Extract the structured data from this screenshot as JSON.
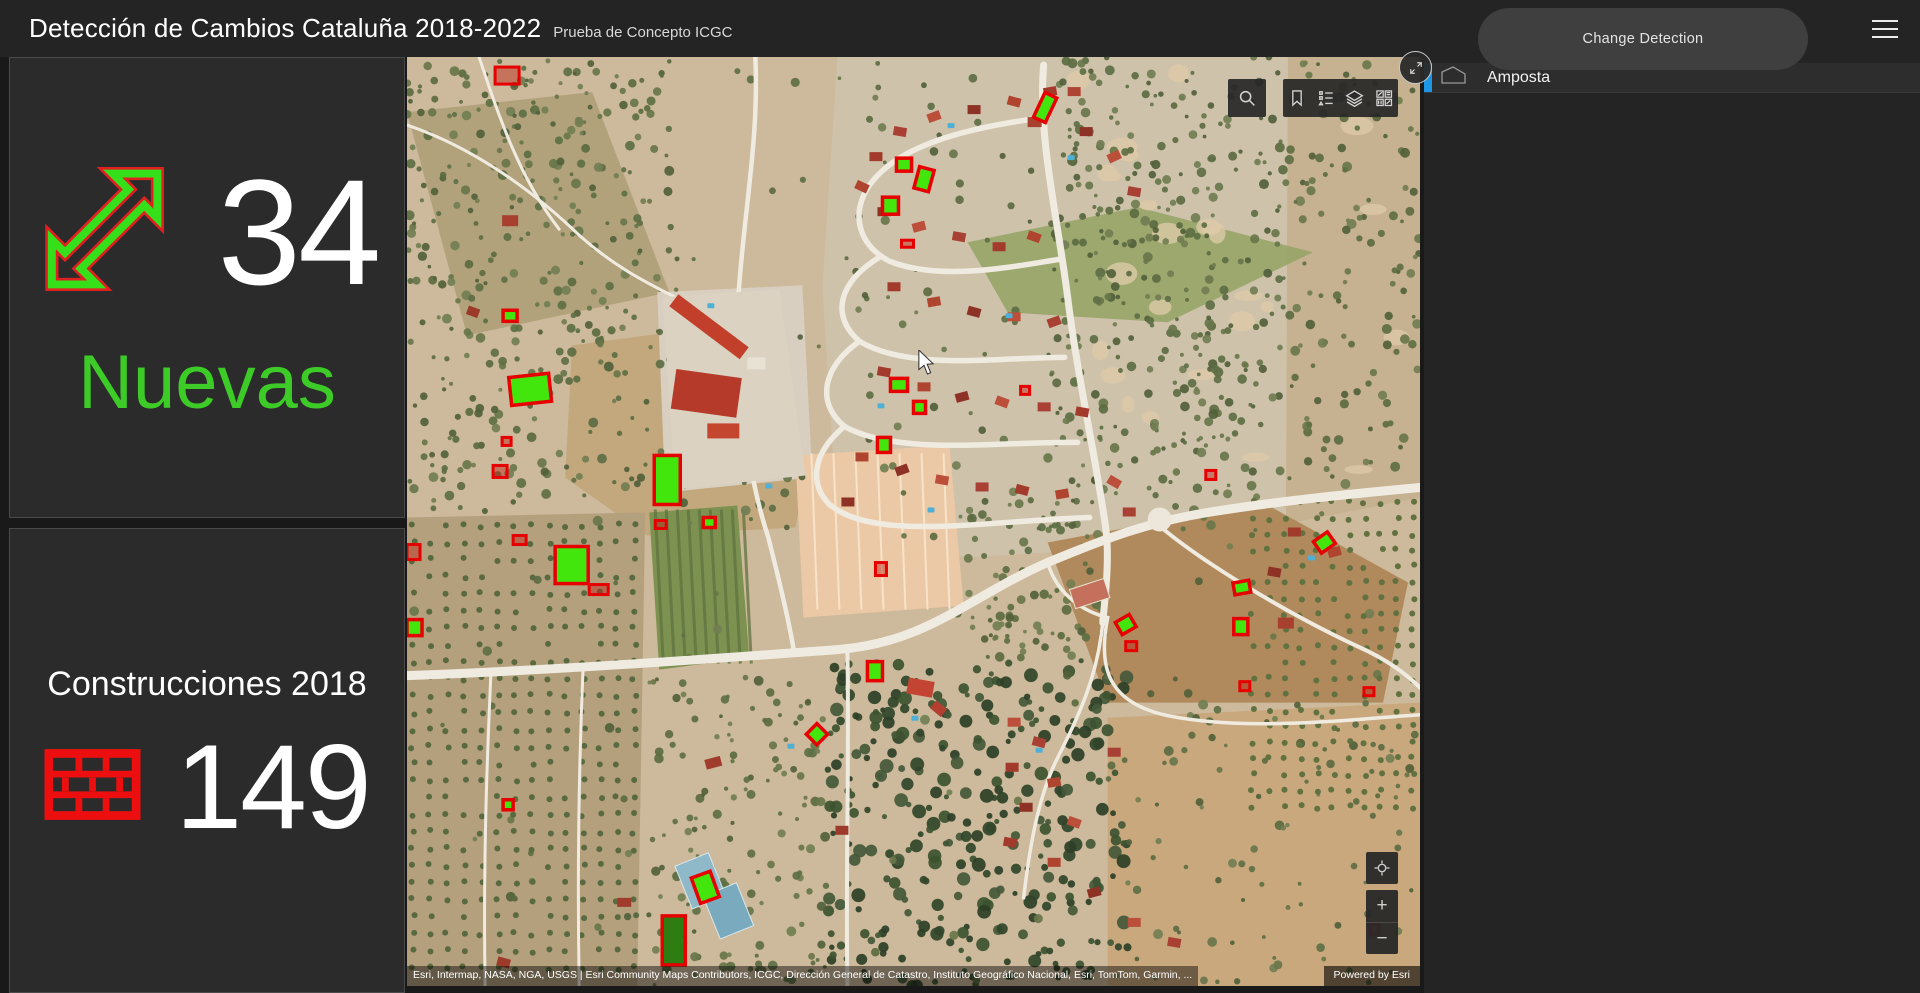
{
  "header": {
    "title": "Detección de Cambios Cataluña 2018-2022",
    "subtitle": "Prueba de Concepto ICGC",
    "change_detection_label": "Change Detection",
    "menu_icon": "hamburger-menu"
  },
  "stats": {
    "nuevas": {
      "value": "34",
      "label": "Nuevas",
      "icon": "arrow-up-right-icon",
      "label_color": "#3DCB27",
      "icon_green": "#35E01A",
      "icon_red": "#E02020"
    },
    "construcciones": {
      "value": "149",
      "label": "Construcciones 2018",
      "icon": "brick-wall-icon",
      "icon_color": "#ED0F0F"
    }
  },
  "map": {
    "toolbar_icons": [
      "search-icon",
      "bookmark-icon",
      "legend-list-icon",
      "layers-icon",
      "basemap-gallery-icon"
    ],
    "corner_button_icon": "expand-icon",
    "controls": {
      "locate_icon": "locate-icon",
      "zoom_in": "+",
      "zoom_out": "−"
    },
    "attribution": "Esri, Intermap, NASA, NGA, USGS | Esri Community Maps Contributors, ICGC, Dirección General de Catastro, Instituto Geográfico Nacional, Esri, TomTom, Garmin, ...",
    "powered_by": "Powered by Esri",
    "marker_colors": {
      "nueva_fill": "#43E60C",
      "nueva_fill_dark": "#2E7D12",
      "stroke": "#E60000",
      "construccion_fill": "rgba(190,30,20,0.45)"
    },
    "markers": [
      {
        "x": 96,
        "y": 253,
        "w": 14,
        "h": 11,
        "r": 0,
        "t": "n"
      },
      {
        "x": 103,
        "y": 318,
        "w": 40,
        "h": 28,
        "r": -6,
        "t": "n"
      },
      {
        "x": 247,
        "y": 398,
        "w": 26,
        "h": 49,
        "r": 0,
        "t": "n"
      },
      {
        "x": 489,
        "y": 101,
        "w": 15,
        "h": 13,
        "r": 0,
        "t": "n"
      },
      {
        "x": 509,
        "y": 111,
        "w": 15,
        "h": 22,
        "r": 15,
        "t": "n"
      },
      {
        "x": 475,
        "y": 140,
        "w": 16,
        "h": 17,
        "r": 0,
        "t": "n"
      },
      {
        "x": 483,
        "y": 321,
        "w": 17,
        "h": 13,
        "r": 0,
        "t": "n"
      },
      {
        "x": 470,
        "y": 380,
        "w": 13,
        "h": 15,
        "r": 0,
        "t": "n"
      },
      {
        "x": 506,
        "y": 344,
        "w": 12,
        "h": 12,
        "r": 0,
        "t": "n"
      },
      {
        "x": 631,
        "y": 37,
        "w": 13,
        "h": 27,
        "r": 25,
        "t": "n"
      },
      {
        "x": 148,
        "y": 489,
        "w": 33,
        "h": 37,
        "r": 0,
        "t": "n"
      },
      {
        "x": 0,
        "y": 562,
        "w": 15,
        "h": 16,
        "r": 0,
        "t": "n"
      },
      {
        "x": 296,
        "y": 460,
        "w": 12,
        "h": 10,
        "r": 0,
        "t": "n"
      },
      {
        "x": 460,
        "y": 604,
        "w": 15,
        "h": 19,
        "r": 0,
        "t": "n"
      },
      {
        "x": 402,
        "y": 669,
        "w": 15,
        "h": 15,
        "r": 45,
        "t": "n"
      },
      {
        "x": 96,
        "y": 742,
        "w": 10,
        "h": 10,
        "r": 0,
        "t": "n"
      },
      {
        "x": 288,
        "y": 816,
        "w": 20,
        "h": 27,
        "r": -20,
        "t": "n"
      },
      {
        "x": 255,
        "y": 858,
        "w": 23,
        "h": 49,
        "r": 0,
        "t": "n",
        "dark": true
      },
      {
        "x": 826,
        "y": 561,
        "w": 14,
        "h": 16,
        "r": 0,
        "t": "n"
      },
      {
        "x": 710,
        "y": 560,
        "w": 16,
        "h": 14,
        "r": -30,
        "t": "n"
      },
      {
        "x": 908,
        "y": 478,
        "w": 17,
        "h": 14,
        "r": -35,
        "t": "n"
      },
      {
        "x": 826,
        "y": 524,
        "w": 16,
        "h": 12,
        "r": -10,
        "t": "n"
      },
      {
        "x": 88,
        "y": 10,
        "w": 24,
        "h": 17,
        "r": 0,
        "t": "c"
      },
      {
        "x": 494,
        "y": 183,
        "w": 12,
        "h": 7,
        "r": 0,
        "t": "c"
      },
      {
        "x": 95,
        "y": 380,
        "w": 9,
        "h": 8,
        "r": 0,
        "t": "c"
      },
      {
        "x": 86,
        "y": 408,
        "w": 14,
        "h": 12,
        "r": 0,
        "t": "c"
      },
      {
        "x": 613,
        "y": 329,
        "w": 9,
        "h": 8,
        "r": 0,
        "t": "c"
      },
      {
        "x": 798,
        "y": 413,
        "w": 10,
        "h": 9,
        "r": 0,
        "t": "c"
      },
      {
        "x": 0,
        "y": 487,
        "w": 13,
        "h": 15,
        "r": 0,
        "t": "c"
      },
      {
        "x": 106,
        "y": 478,
        "w": 13,
        "h": 9,
        "r": 0,
        "t": "c"
      },
      {
        "x": 248,
        "y": 463,
        "w": 11,
        "h": 8,
        "r": 0,
        "t": "c"
      },
      {
        "x": 182,
        "y": 527,
        "w": 19,
        "h": 10,
        "r": 0,
        "t": "c"
      },
      {
        "x": 468,
        "y": 505,
        "w": 11,
        "h": 13,
        "r": 0,
        "t": "c"
      },
      {
        "x": 718,
        "y": 584,
        "w": 11,
        "h": 9,
        "r": 0,
        "t": "c"
      },
      {
        "x": 832,
        "y": 624,
        "w": 10,
        "h": 9,
        "r": 0,
        "t": "c"
      },
      {
        "x": 956,
        "y": 630,
        "w": 10,
        "h": 8,
        "r": 0,
        "t": "c"
      },
      {
        "x": 962,
        "y": 866,
        "w": 9,
        "h": 11,
        "r": 0,
        "t": "c"
      }
    ]
  },
  "legend": {
    "items": [
      {
        "label": "Amposta",
        "icon": "polygon-outline-icon",
        "accent": "#1E96E6"
      }
    ]
  }
}
